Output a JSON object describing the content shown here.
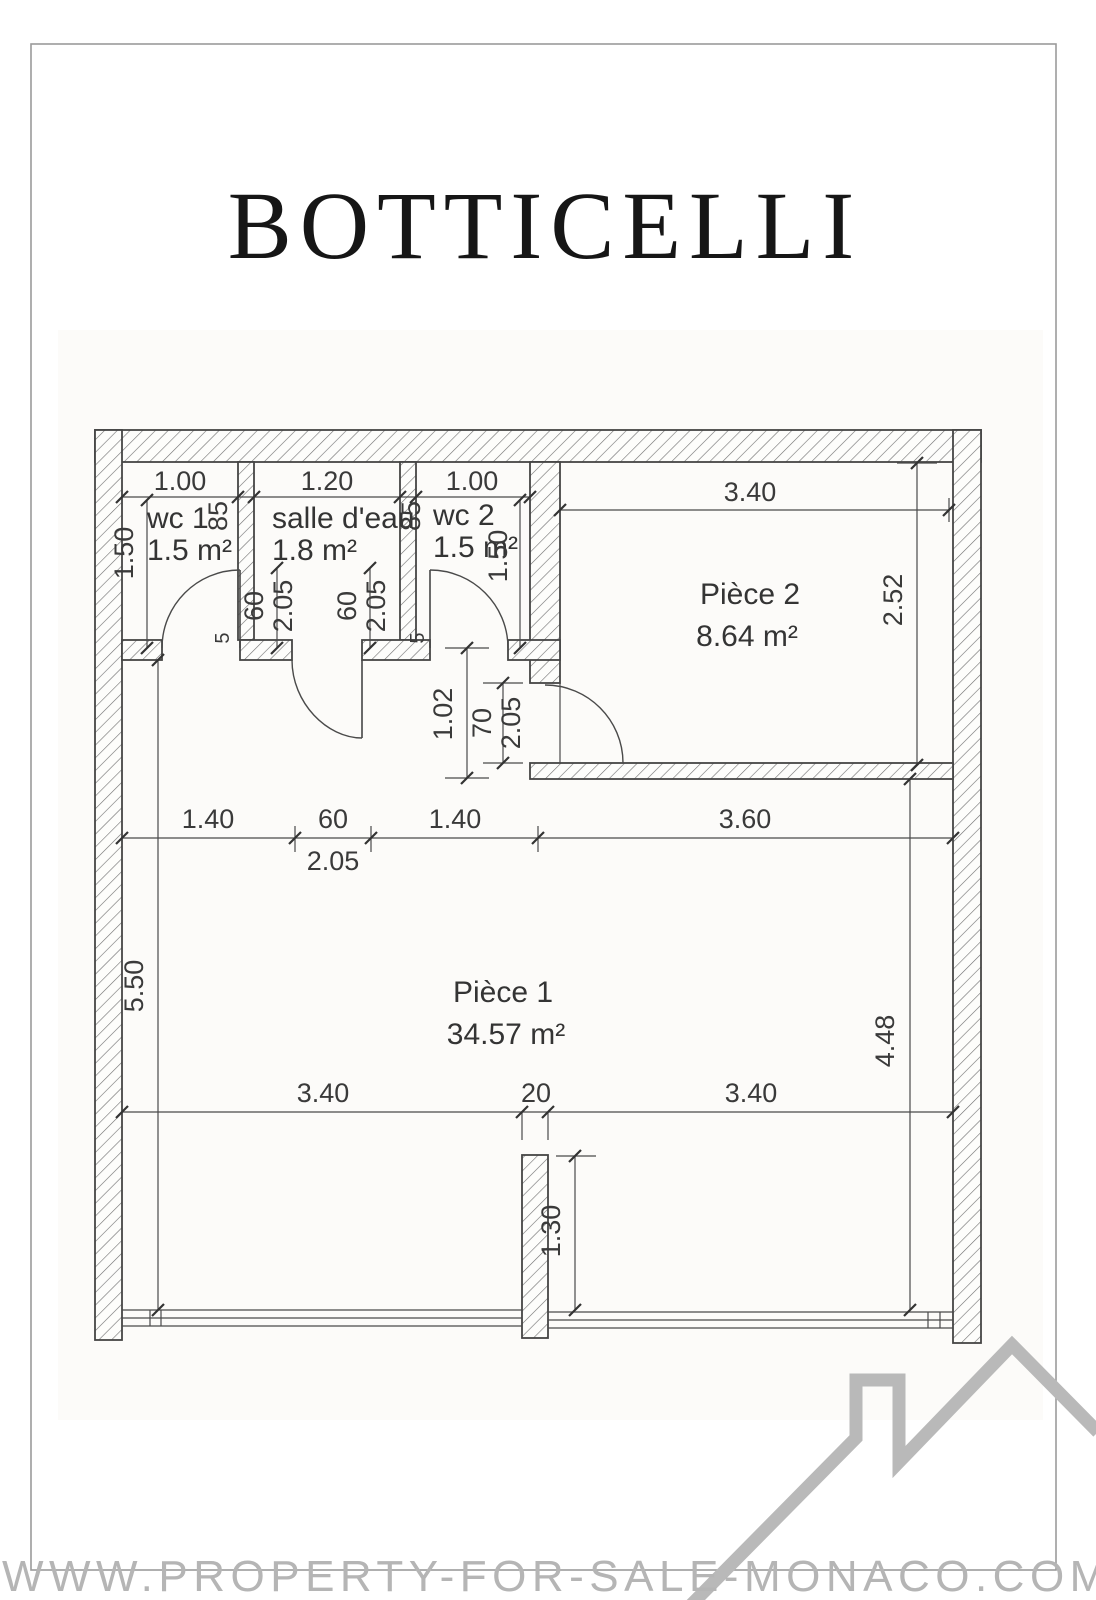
{
  "title": "BOTTICELLI",
  "watermark": "WWW.PROPERTY-FOR-SALE-MONACO.COM",
  "colors": {
    "plan_line": "#454545",
    "text": "#3a3a3a",
    "watermark": "#b5b5b5",
    "logo": "#b9b9b9",
    "page_border": "#9b9b9b"
  },
  "rooms": {
    "wc1": {
      "name": "wc 1",
      "area": "1.5 m²"
    },
    "salle": {
      "name": "salle d'eau",
      "area": "1.8 m²"
    },
    "wc2": {
      "name": "wc 2",
      "area": "1.5 m²"
    },
    "piece2": {
      "name": "Pièce 2",
      "area": "8.64 m²"
    },
    "piece1": {
      "name": "Pièce 1",
      "area": "34.57 m²"
    }
  },
  "dims": {
    "wc1_width": "1.00",
    "salle_width": "1.20",
    "wc2_width": "1.00",
    "piece2_width": "3.40",
    "wc1_height": "1.50",
    "wc2_height": "1.50",
    "wc1_depth": "85",
    "wc2_depth": "85",
    "piece2_height": "2.52",
    "door1_width": "60",
    "door1_height": "2.05",
    "door2_width": "60",
    "door2_height": "2.05",
    "threshold1": "5",
    "threshold2": "5",
    "hall_width": "1.02",
    "piece2_door_width": "70",
    "piece2_door_height": "2.05",
    "mid_seg1": "1.40",
    "mid_seg2": "60",
    "mid_seg2_height": "2.05",
    "mid_seg3": "1.40",
    "mid_seg4": "3.60",
    "left_height": "5.50",
    "right_height": "4.48",
    "bottom_seg1": "3.40",
    "bottom_seg2": "20",
    "bottom_seg3": "3.40",
    "pillar_offset": "1.30"
  }
}
